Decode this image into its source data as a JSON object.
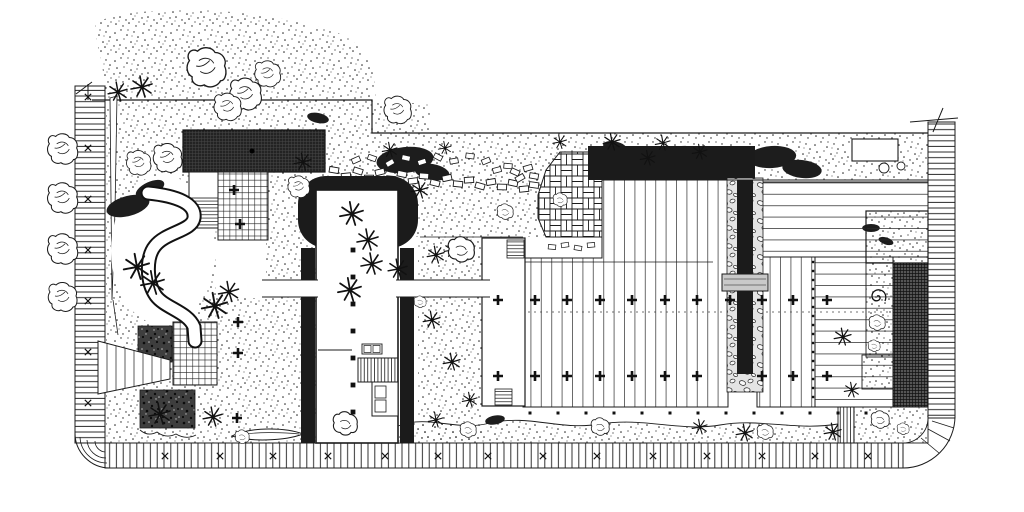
{
  "canvas": {
    "width": 1024,
    "height": 512
  },
  "palette": {
    "paper": "#ffffff",
    "ink": "#1b1b1b",
    "mid": "#4a4a4a",
    "light_gray": "#c9c9c9",
    "stone_bg": "#e4e4e4"
  },
  "regions": [
    {
      "name": "perimeter-boardwalk-left",
      "surface": "plank-rungs-horizontal"
    },
    {
      "name": "perimeter-sidewalk-bottom",
      "surface": "plank-rungs-vertical"
    },
    {
      "name": "perimeter-boardwalk-right",
      "surface": "plank-rungs-horizontal"
    },
    {
      "name": "entry-pavilion-roof",
      "surface": "dark-crosshatch"
    },
    {
      "name": "grid-paved-plaza-upper",
      "surface": "square-grid-pavers"
    },
    {
      "name": "grid-paved-plaza-lower",
      "surface": "square-grid-pavers"
    },
    {
      "name": "winding-path",
      "surface": "smooth-paving"
    },
    {
      "name": "stepping-stone-walk",
      "surface": "scattered-flagstones"
    },
    {
      "name": "brick-patio",
      "surface": "basketweave-brick"
    },
    {
      "name": "pergola-bar",
      "surface": "solid-dark"
    },
    {
      "name": "water-rill",
      "surface": "dark-channel-in-pebbles"
    },
    {
      "name": "main-deck",
      "surface": "timber-planks-vertical"
    },
    {
      "name": "side-deck",
      "surface": "timber-planks-horizontal"
    },
    {
      "name": "central-building",
      "surface": "white-floor-plan"
    },
    {
      "name": "planting-beds",
      "surface": "stipple"
    },
    {
      "name": "dark-ground-cover-beds",
      "surface": "dense-stipple"
    }
  ],
  "plan": {
    "layers": [
      {
        "group": "street-trees",
        "symbol": "tree",
        "items": [
          [
            63,
            148,
            1.05
          ],
          [
            63,
            197,
            1.05
          ],
          [
            63,
            248,
            1.05
          ],
          [
            63,
            296,
            1.0
          ]
        ]
      },
      {
        "group": "canopy-trees",
        "symbol": "tree",
        "items": [
          [
            207,
            66,
            1.35
          ],
          [
            246,
            93,
            1.1
          ],
          [
            268,
            73,
            0.9
          ],
          [
            228,
            106,
            0.95
          ],
          [
            168,
            157,
            1.0
          ],
          [
            139,
            162,
            0.85
          ],
          [
            398,
            109,
            0.95
          ],
          [
            299,
            186,
            0.75
          ]
        ]
      },
      {
        "group": "shrub-masses",
        "symbol": "blob",
        "items": [
          [
            128,
            206,
            2.0,
            -15
          ],
          [
            150,
            189,
            1.4,
            -25
          ],
          [
            405,
            160,
            2.6,
            -6
          ],
          [
            432,
            172,
            1.6,
            10
          ],
          [
            615,
            147,
            1.1,
            12
          ],
          [
            682,
            151,
            1.0,
            -8
          ],
          [
            726,
            162,
            0.9,
            6
          ],
          [
            772,
            157,
            2.2,
            -4
          ],
          [
            802,
            169,
            1.8,
            7
          ],
          [
            871,
            228,
            0.8,
            0
          ],
          [
            886,
            241,
            0.7,
            18
          ],
          [
            495,
            420,
            0.9,
            -10
          ],
          [
            318,
            118,
            1.0,
            12
          ]
        ]
      },
      {
        "group": "palm-plants",
        "symbol": "palm",
        "items": [
          [
            118,
            92,
            0.9
          ],
          [
            142,
            87,
            1.0
          ],
          [
            137,
            267,
            1.2
          ],
          [
            153,
            283,
            1.1
          ],
          [
            215,
            306,
            1.2
          ],
          [
            229,
            292,
            0.95
          ],
          [
            352,
            214,
            1.1
          ],
          [
            368,
            240,
            1.0
          ],
          [
            372,
            264,
            1.0
          ],
          [
            350,
            290,
            1.1
          ],
          [
            398,
            269,
            0.9
          ],
          [
            420,
            190,
            0.8
          ],
          [
            303,
            162,
            0.8
          ],
          [
            436,
            255,
            0.8
          ],
          [
            452,
            250,
            0.7
          ],
          [
            390,
            150,
            0.7
          ],
          [
            445,
            148,
            0.6
          ],
          [
            560,
            142,
            0.65
          ],
          [
            612,
            142,
            0.8
          ],
          [
            648,
            158,
            0.7
          ],
          [
            663,
            143,
            0.7
          ],
          [
            700,
            152,
            0.7
          ],
          [
            160,
            414,
            1.0
          ],
          [
            213,
            417,
            0.9
          ],
          [
            432,
            320,
            0.8
          ],
          [
            452,
            362,
            0.8
          ],
          [
            470,
            400,
            0.7
          ],
          [
            436,
            420,
            0.7
          ],
          [
            843,
            337,
            0.8
          ],
          [
            852,
            390,
            0.7
          ],
          [
            833,
            432,
            0.8
          ],
          [
            745,
            433,
            0.8
          ],
          [
            700,
            427,
            0.7
          ]
        ]
      },
      {
        "group": "plant-circles",
        "symbol": "bush",
        "items": [
          [
            345,
            424,
            1.2
          ],
          [
            600,
            427,
            0.9
          ],
          [
            877,
            323,
            0.8
          ],
          [
            874,
            346,
            0.6
          ],
          [
            880,
            420,
            0.9
          ],
          [
            903,
            429,
            0.6
          ],
          [
            461,
            250,
            1.3
          ],
          [
            505,
            212,
            0.8
          ],
          [
            468,
            430,
            0.8
          ],
          [
            420,
            302,
            0.6
          ],
          [
            242,
            437,
            0.7
          ],
          [
            765,
            432,
            0.8
          ],
          [
            560,
            200,
            0.7
          ]
        ]
      },
      {
        "group": "stepping-stones",
        "symbol": "stone",
        "items": [
          [
            334,
            170,
            1,
            10
          ],
          [
            346,
            176,
            1,
            -6
          ],
          [
            358,
            171,
            1,
            18
          ],
          [
            369,
            178,
            1,
            0
          ],
          [
            380,
            172,
            1,
            -14
          ],
          [
            391,
            179,
            1,
            6
          ],
          [
            402,
            174,
            1,
            12
          ],
          [
            413,
            181,
            1,
            -8
          ],
          [
            424,
            176,
            1,
            4
          ],
          [
            435,
            183,
            1,
            14
          ],
          [
            447,
            178,
            1,
            -12
          ],
          [
            458,
            184,
            1,
            6
          ],
          [
            469,
            180,
            1,
            -4
          ],
          [
            480,
            186,
            1,
            16
          ],
          [
            491,
            182,
            1,
            -10
          ],
          [
            502,
            187,
            1,
            2
          ],
          [
            513,
            183,
            1,
            12
          ],
          [
            524,
            189,
            1,
            -6
          ],
          [
            534,
            185,
            1,
            8
          ],
          [
            356,
            160,
            0.9,
            -24
          ],
          [
            372,
            158,
            0.9,
            20
          ],
          [
            390,
            163,
            0.9,
            -30
          ],
          [
            406,
            158,
            0.9,
            12
          ],
          [
            422,
            162,
            0.9,
            -18
          ],
          [
            438,
            157,
            0.9,
            28
          ],
          [
            454,
            161,
            0.9,
            -10
          ],
          [
            470,
            156,
            0.9,
            8
          ],
          [
            486,
            161,
            0.9,
            -22
          ],
          [
            515,
            172,
            0.95,
            24
          ],
          [
            528,
            168,
            0.95,
            -16
          ],
          [
            520,
            178,
            0.95,
            -30
          ],
          [
            534,
            176,
            0.95,
            10
          ],
          [
            508,
            166,
            0.9,
            5
          ],
          [
            497,
            170,
            0.9,
            -15
          ],
          [
            552,
            247,
            0.8,
            5
          ],
          [
            565,
            245,
            0.8,
            -8
          ],
          [
            578,
            248,
            0.8,
            10
          ],
          [
            591,
            245,
            0.8,
            -5
          ]
        ]
      },
      {
        "group": "deck-trees",
        "symbol": "plus",
        "items": [
          [
            498,
            300
          ],
          [
            535,
            300
          ],
          [
            567,
            300
          ],
          [
            600,
            300
          ],
          [
            632,
            300
          ],
          [
            665,
            300
          ],
          [
            697,
            300
          ],
          [
            730,
            300
          ],
          [
            762,
            300
          ],
          [
            793,
            300
          ],
          [
            827,
            300
          ],
          [
            498,
            376
          ],
          [
            535,
            376
          ],
          [
            567,
            376
          ],
          [
            600,
            376
          ],
          [
            632,
            376
          ],
          [
            665,
            376
          ],
          [
            697,
            376
          ],
          [
            762,
            376
          ],
          [
            793,
            376
          ],
          [
            827,
            376
          ],
          [
            234,
            190
          ],
          [
            240,
            224
          ],
          [
            238,
            322
          ],
          [
            238,
            353
          ],
          [
            237,
            418
          ]
        ]
      },
      {
        "group": "walk-x-marks",
        "symbol": "xmark",
        "items": [
          [
            165,
            456
          ],
          [
            220,
            456
          ],
          [
            273,
            456
          ],
          [
            328,
            456
          ],
          [
            385,
            456
          ],
          [
            438,
            456
          ],
          [
            488,
            456
          ],
          [
            543,
            456
          ],
          [
            597,
            456
          ],
          [
            653,
            456
          ],
          [
            707,
            456
          ],
          [
            762,
            456
          ],
          [
            815,
            456
          ],
          [
            868,
            456
          ],
          [
            88,
            97
          ],
          [
            88,
            148
          ],
          [
            88,
            199
          ],
          [
            88,
            250
          ],
          [
            88,
            301
          ],
          [
            88,
            352
          ],
          [
            88,
            403
          ]
        ]
      },
      {
        "group": "deck-edge-dots",
        "symbol": "dot",
        "items": [
          [
            530,
            413
          ],
          [
            558,
            413
          ],
          [
            586,
            413
          ],
          [
            614,
            413
          ],
          [
            642,
            413
          ],
          [
            670,
            413
          ],
          [
            698,
            413
          ],
          [
            726,
            413
          ],
          [
            754,
            413
          ],
          [
            782,
            413
          ],
          [
            810,
            413
          ],
          [
            838,
            413
          ],
          [
            866,
            413
          ]
        ]
      },
      {
        "group": "deck-divider-dots",
        "symbol": "dot",
        "items": [
          [
            813,
            262,
            0.8
          ],
          [
            813,
            271,
            0.8
          ],
          [
            813,
            280,
            0.8
          ],
          [
            813,
            289,
            0.8
          ],
          [
            813,
            298,
            0.8
          ],
          [
            813,
            307,
            0.8
          ],
          [
            813,
            316,
            0.8
          ],
          [
            813,
            325,
            0.8
          ],
          [
            813,
            334,
            0.8
          ],
          [
            813,
            343,
            0.8
          ],
          [
            813,
            352,
            0.8
          ],
          [
            813,
            361,
            0.8
          ],
          [
            813,
            370,
            0.8
          ],
          [
            813,
            379,
            0.8
          ],
          [
            813,
            388,
            0.8
          ],
          [
            813,
            397,
            0.8
          ]
        ]
      },
      {
        "group": "building-columns",
        "symbol": "dot",
        "items": [
          [
            353,
            250,
            1.6
          ],
          [
            353,
            277,
            1.6
          ],
          [
            353,
            304,
            1.6
          ],
          [
            353,
            331,
            1.6
          ],
          [
            353,
            358,
            1.6
          ],
          [
            353,
            385,
            1.6
          ],
          [
            353,
            412,
            1.6
          ]
        ]
      }
    ]
  }
}
